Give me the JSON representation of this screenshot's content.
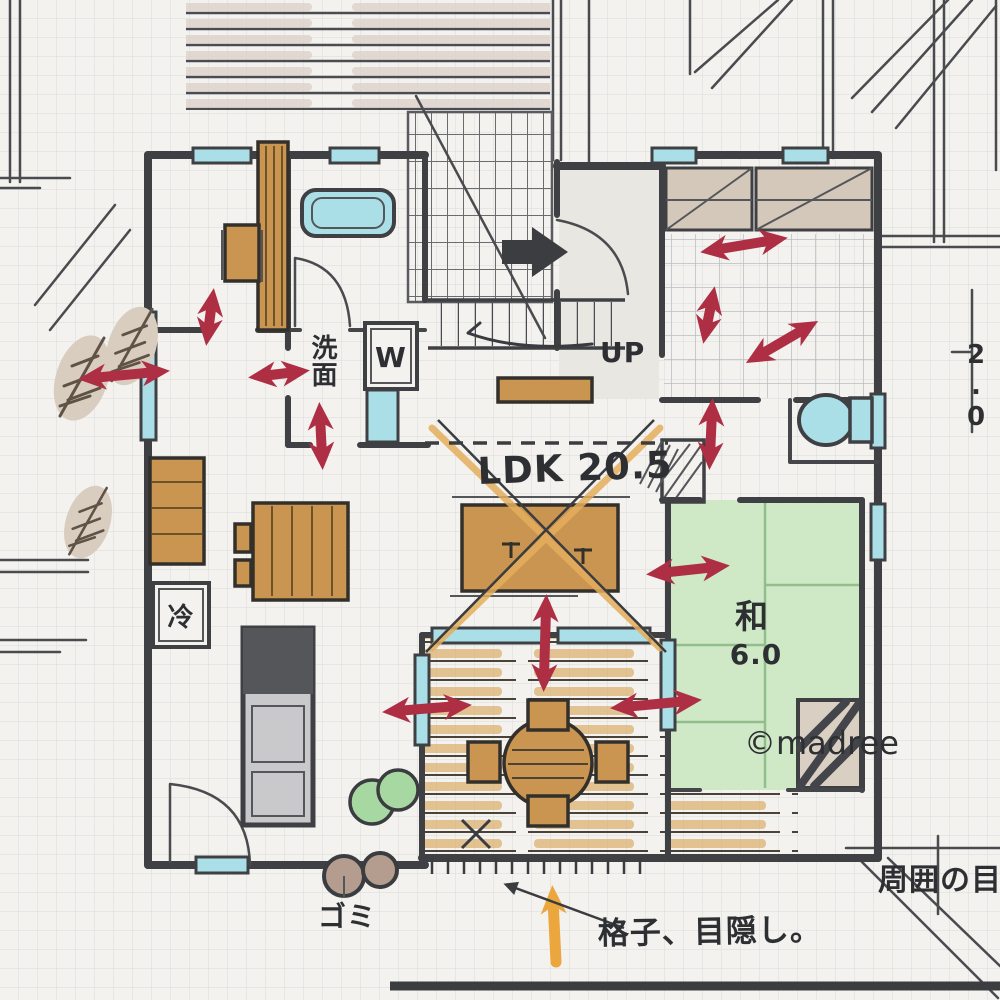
{
  "title": "hand-drawn floor plan sketch",
  "labels": {
    "ldk": "LDK 20.5",
    "washroom": "洗面",
    "washer": "W",
    "stairs_up": "UP",
    "fridge": "冷",
    "tatami_name": "和",
    "tatami_size": "6.0",
    "trash": "ゴミ",
    "privacy_note": "格子、目隠し。",
    "neighbor_note": "周囲の目線",
    "edge_dimension": "2.0",
    "watermark": "©madree"
  },
  "colors": {
    "paper": "#f3f2ef",
    "grid": "#d9dcd8",
    "wall": "#3f4044",
    "window_cyan": "#abdfe7",
    "wood_tan": "#c99551",
    "tatami_green": "#cfe9c7",
    "flow_arrow_red": "#ae2f44",
    "highlight_orange": "#eca63e",
    "watermark_gray": "#868c92"
  }
}
